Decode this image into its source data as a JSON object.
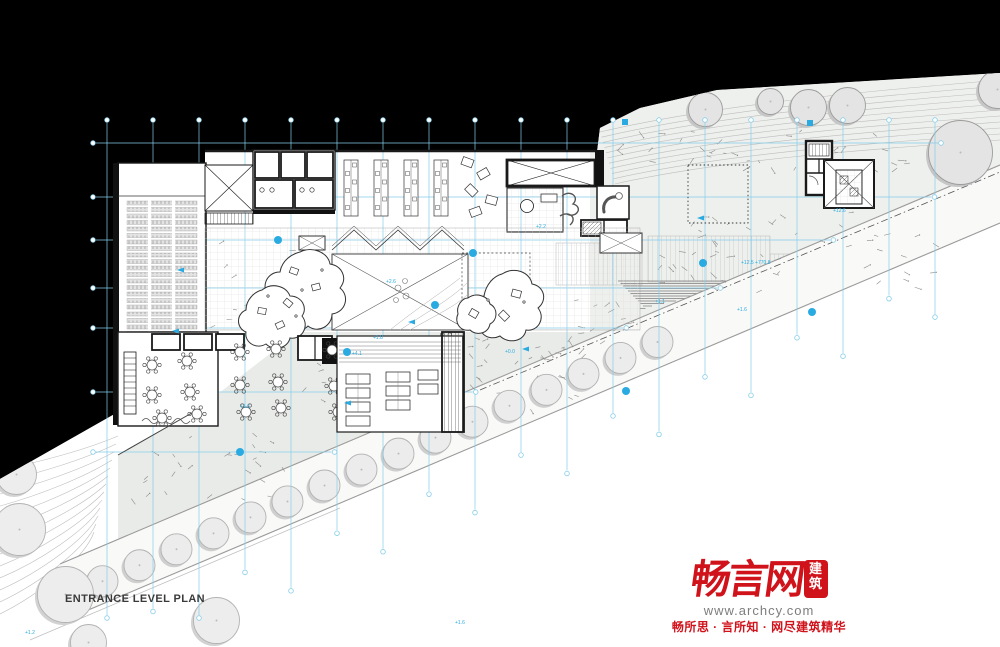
{
  "plan": {
    "title": "ENTRANCE LEVEL PLAN",
    "colors": {
      "backdrop": "#000000",
      "grid_blue": "#85cde9",
      "accent_cyan": "#29abe2",
      "wall": "#1a1a1a",
      "contour_gray": "#bdbdbd",
      "terrain_fill": "#ededeb",
      "terrace_fill": "#e9ebe8",
      "tree_fill": "#ececec",
      "tree_shadow": "#cfcfcf",
      "road_line": "#9a9a9a"
    },
    "grid": {
      "vertical_x": [
        107,
        153,
        199,
        245,
        291,
        337,
        383,
        429,
        475,
        521,
        567,
        613,
        659,
        705,
        751,
        797,
        843,
        889,
        935
      ],
      "horizontal_y": [
        143,
        197,
        240,
        288,
        328,
        392,
        452
      ],
      "top_y": 123
    },
    "trees_road_x": [
      100,
      137,
      174,
      211,
      248,
      285,
      322,
      359,
      396,
      433,
      470,
      507,
      544,
      581,
      618,
      655
    ],
    "trees_terrain": [
      [
        14,
        477,
        20
      ],
      [
        17,
        532,
        26
      ],
      [
        63,
        597,
        28
      ],
      [
        214,
        623,
        23
      ],
      [
        0,
        442,
        16
      ],
      [
        86,
        645,
        18
      ]
    ],
    "trees_upper": [
      [
        703,
        112,
        17
      ],
      [
        768,
        104,
        13
      ],
      [
        806,
        110,
        18
      ],
      [
        845,
        108,
        18
      ],
      [
        958,
        155,
        32
      ],
      [
        995,
        92,
        19
      ]
    ],
    "annotation_dots": [
      [
        278,
        240
      ],
      [
        435,
        305
      ],
      [
        473,
        253
      ],
      [
        703,
        263
      ],
      [
        240,
        452
      ],
      [
        626,
        391
      ],
      [
        812,
        312
      ],
      [
        347,
        352
      ]
    ],
    "annotation_squares": [
      [
        625,
        122
      ],
      [
        810,
        123
      ]
    ],
    "annotation_triangles": [
      [
        172,
        331
      ],
      [
        408,
        322
      ],
      [
        344,
        403
      ],
      [
        522,
        349
      ],
      [
        697,
        218
      ],
      [
        177,
        270
      ]
    ],
    "level_annotations": [
      {
        "t": "+12.5 +770.8",
        "x": 741,
        "y": 264
      },
      {
        "t": "+1.6",
        "x": 737,
        "y": 311
      },
      {
        "t": "+1.1",
        "x": 655,
        "y": 303
      },
      {
        "t": "+2.6",
        "x": 386,
        "y": 283
      },
      {
        "t": "+1.8",
        "x": 373,
        "y": 339
      },
      {
        "t": "+0.0",
        "x": 505,
        "y": 353
      },
      {
        "t": "+12.6",
        "x": 833,
        "y": 212
      },
      {
        "t": "+1.6",
        "x": 455,
        "y": 624
      },
      {
        "t": "+1.2",
        "x": 25,
        "y": 634
      },
      {
        "t": "+2.2",
        "x": 536,
        "y": 228
      },
      {
        "t": "+1.6",
        "x": 240,
        "y": 408
      },
      {
        "t": "+4.1",
        "x": 352,
        "y": 355
      }
    ],
    "restaurant_tables": [
      [
        152,
        365
      ],
      [
        187,
        361
      ],
      [
        152,
        395
      ],
      [
        190,
        392
      ],
      [
        162,
        418
      ],
      [
        197,
        414
      ]
    ],
    "patio_tables": [
      [
        240,
        352
      ],
      [
        276,
        349
      ],
      [
        240,
        385
      ],
      [
        278,
        382
      ],
      [
        246,
        412
      ],
      [
        281,
        408
      ]
    ],
    "terrace_tables": [
      [
        332,
        350
      ],
      [
        370,
        347
      ],
      [
        408,
        344
      ],
      [
        446,
        341
      ],
      [
        334,
        386
      ],
      [
        372,
        383
      ],
      [
        410,
        380
      ],
      [
        338,
        412
      ],
      [
        376,
        408
      ]
    ]
  },
  "watermark": {
    "logo_text": "畅言网",
    "logo_seal": "建筑",
    "url": "www.archcy.com",
    "tagline": "畅所思 · 言所知 · 网尽建筑精华",
    "brand_red": "#d0121b"
  }
}
